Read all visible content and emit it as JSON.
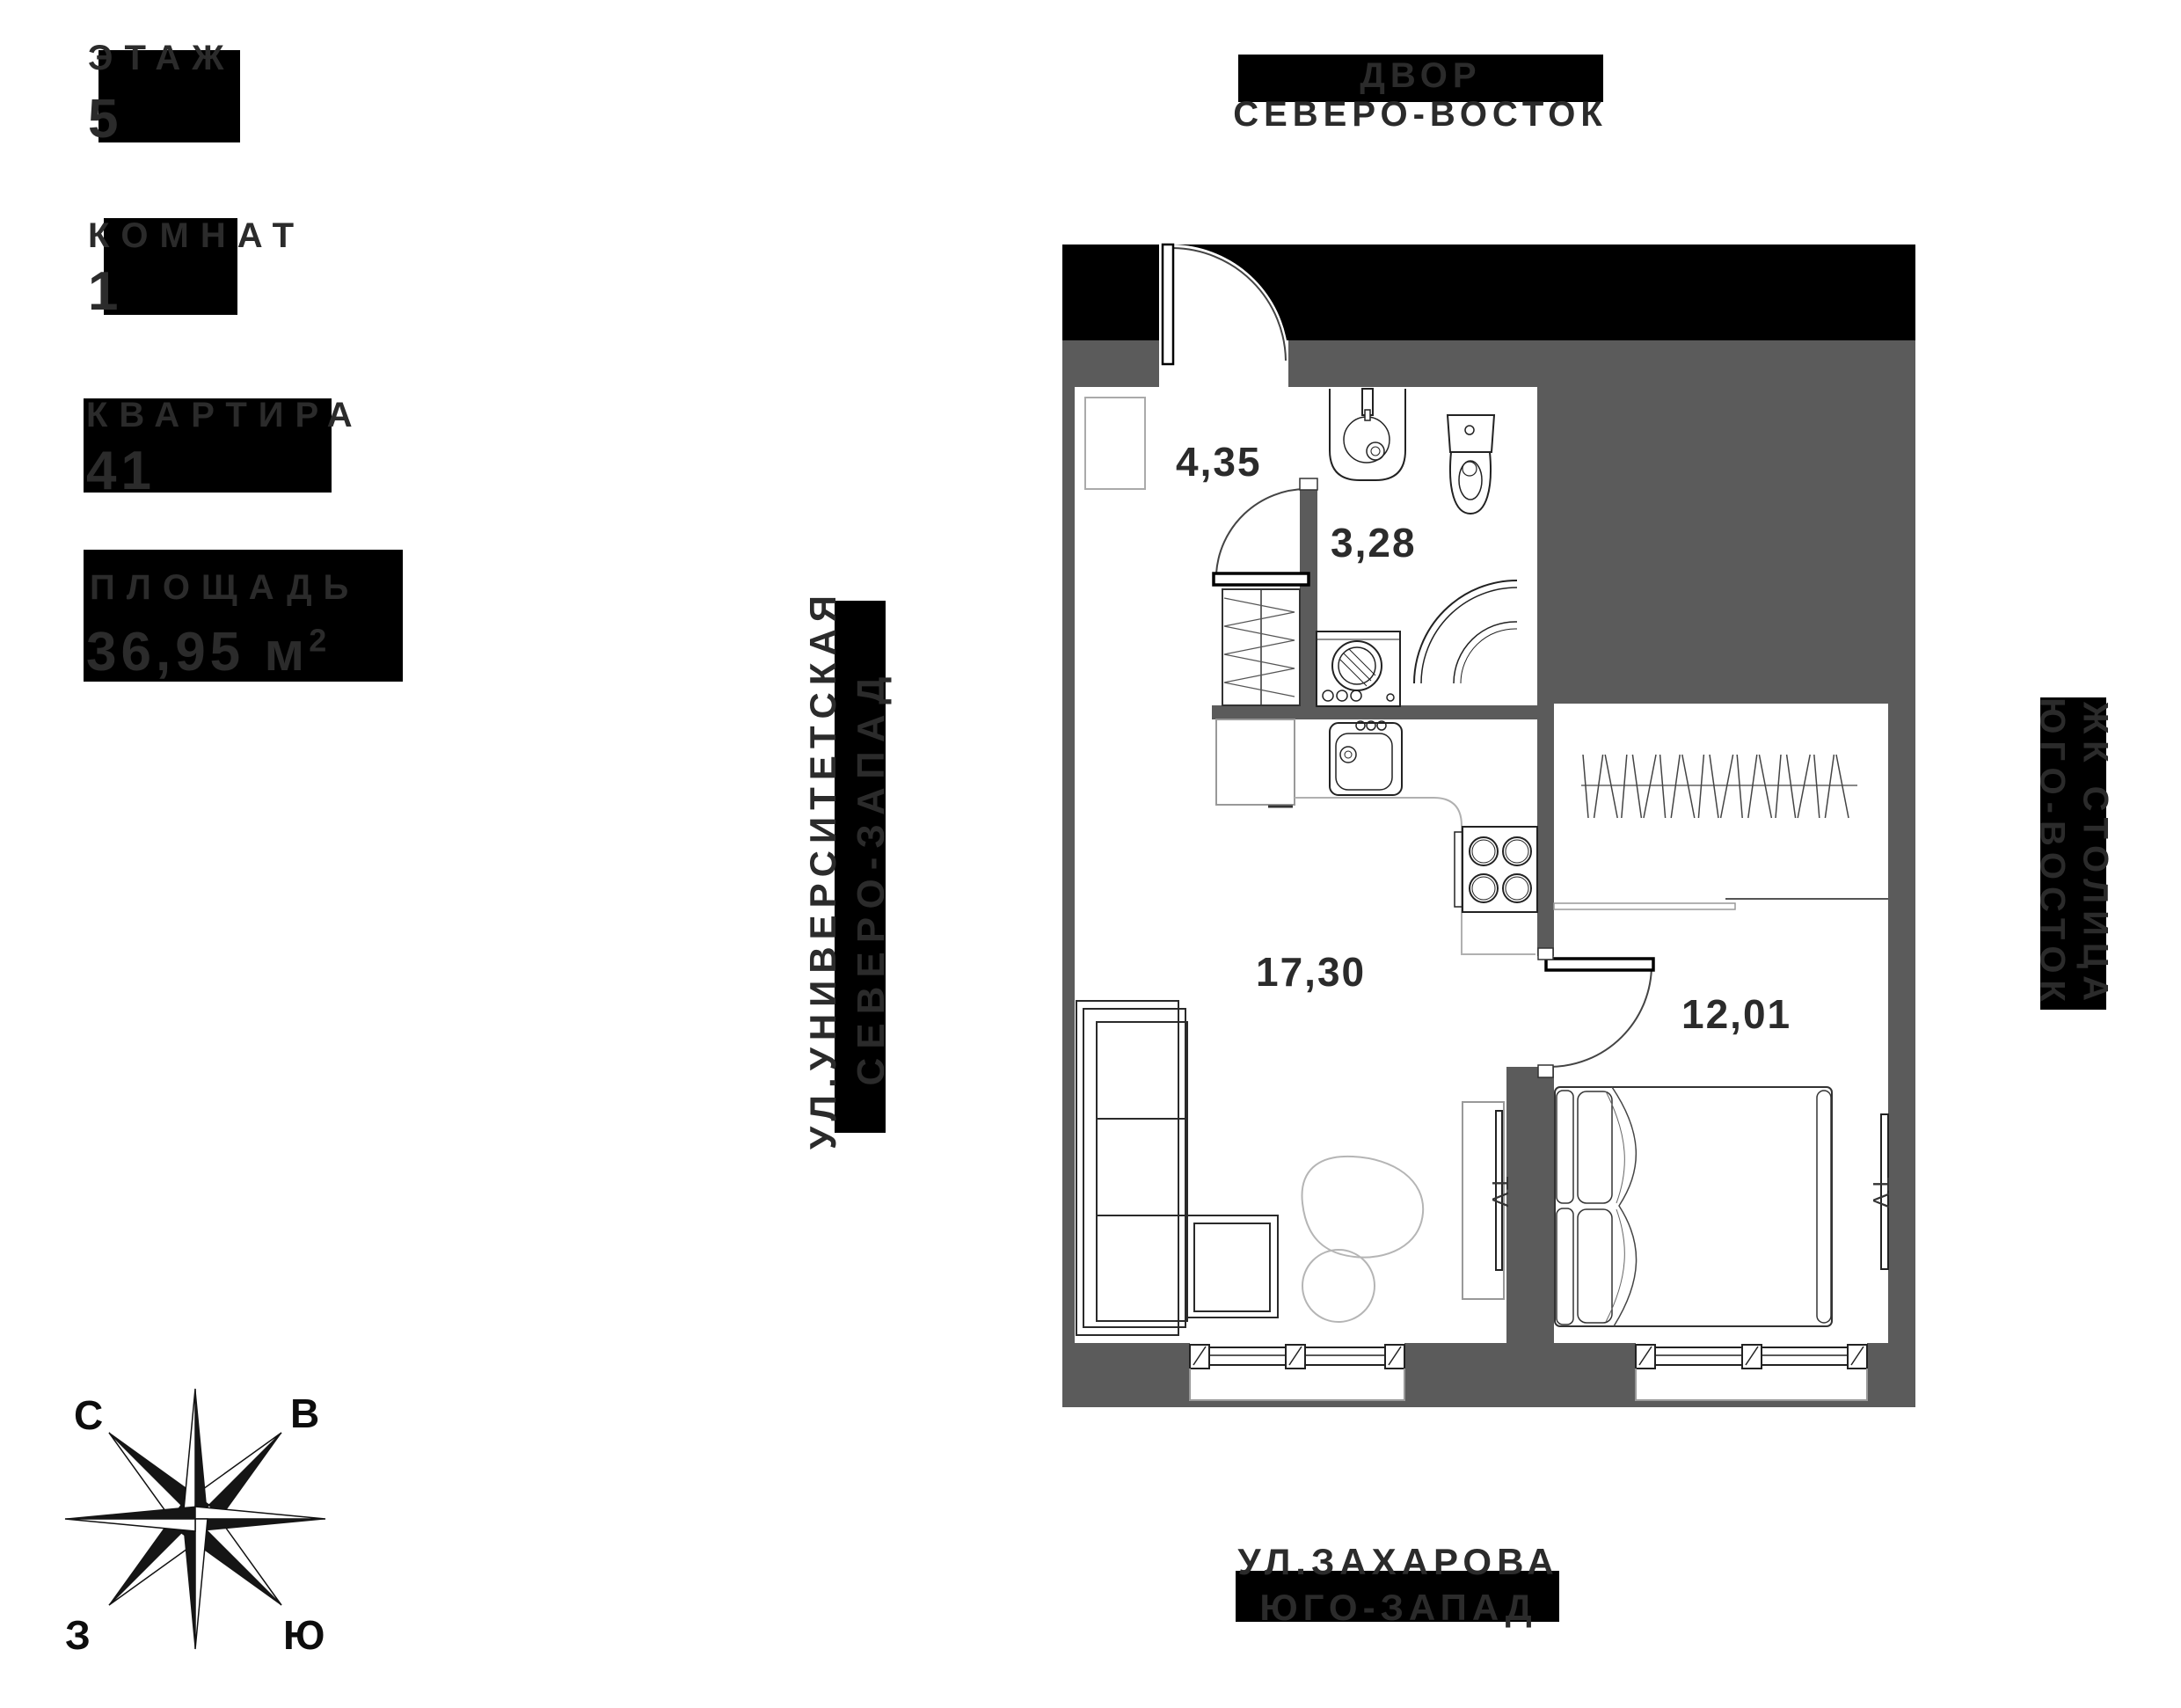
{
  "info_panel": {
    "floor": {
      "label": "ЭТАЖ",
      "value": "5"
    },
    "rooms": {
      "label": "КОМНАТ",
      "value": "1"
    },
    "apartment": {
      "label": "КВАРТИРА",
      "value": "41"
    },
    "area": {
      "label": "ПЛОЩАДЬ",
      "value": "36,95 м",
      "sup": "2"
    }
  },
  "surroundings": {
    "top": {
      "line1": "ДВОР",
      "line2": "СЕВЕРО-ВОСТОК"
    },
    "bottom": {
      "line1": "УЛ.ЗАХАРОВА",
      "line2": "ЮГО-ЗАПАД"
    },
    "left": {
      "line1": "УЛ.УНИВЕРСИТЕТСКАЯ",
      "line2": "СЕВЕРО-ЗАПАД"
    },
    "right": {
      "line1": "ЖК СТОЛИЦА",
      "line2": "ЮГО-ВОСТОК"
    }
  },
  "compass": {
    "north": "С",
    "east": "В",
    "west": "З",
    "south": "Ю"
  },
  "plan": {
    "hallway_area": "4,35",
    "bathroom_area": "3,28",
    "living_area": "17,30",
    "bedroom_area": "12,01",
    "tv_living": "TV",
    "tv_bedroom": "TV"
  },
  "colors": {
    "wall": "#5b5b5b",
    "band": "#000000",
    "text": "#2b2b2b"
  }
}
